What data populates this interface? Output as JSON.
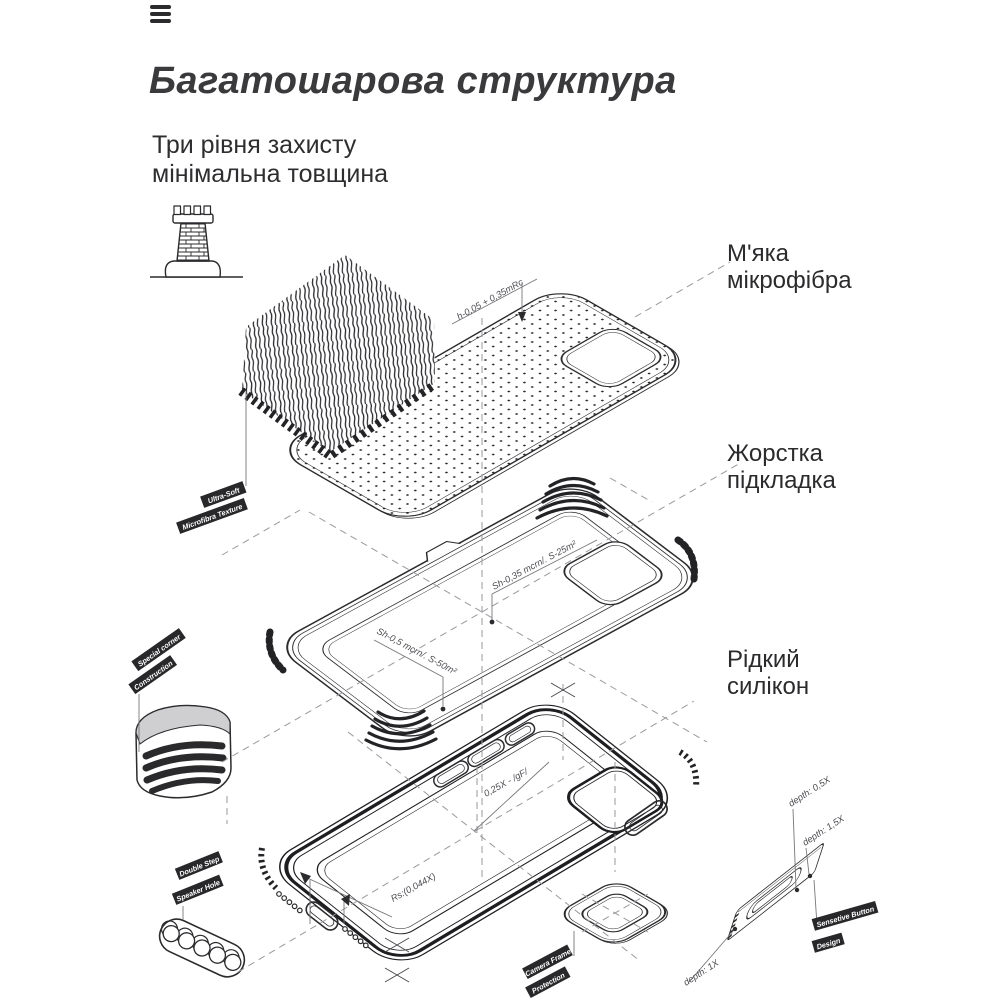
{
  "header": {
    "title": "Багатошарова структура",
    "subtitle": "Три рівня захисту\nмінімальна товщина"
  },
  "icons": {
    "menu": "hamburger-menu-icon",
    "fortress": "castle-tower-icon"
  },
  "layer_labels": [
    {
      "id": "soft-microfiber",
      "text": "М'яка\nмікрофібра"
    },
    {
      "id": "hard-lining",
      "text": "Жорстка\nпідкладка"
    },
    {
      "id": "liquid-silicone",
      "text": "Рідкий\nсилікон"
    }
  ],
  "diagram": {
    "tags": {
      "ultra_soft_1": "Ultra-Soft",
      "ultra_soft_2": "Microfibra Texture",
      "corner_1": "Special corner",
      "corner_2": "Construction",
      "speaker_1": "Double Step",
      "speaker_2": "Speaker Hole",
      "camera_1": "Camera Frame",
      "camera_2": "Protection",
      "button_1": "Sensetive Button",
      "button_2": "Design"
    },
    "annotations": {
      "microfiber_height": "h-0,05 + 0,35mRc",
      "lining_camera": "Sh-0,35 mcrn/. S-25m²",
      "lining_floor": "Sh-0,5 mcrn/. S-50m²",
      "case_wall": "0,25X - /gF/",
      "case_radius": "Rs:(0,044X)",
      "depth_05": "depth: 0,5X",
      "depth_15": "depth: 1,5X",
      "depth_1": "depth: 1X"
    }
  },
  "colors": {
    "ink": "#2b2b2e",
    "title": "#3a3a3c",
    "dash": "#9a9a9e",
    "tag_bg": "#28282a",
    "tag_text": "#ffffff"
  }
}
